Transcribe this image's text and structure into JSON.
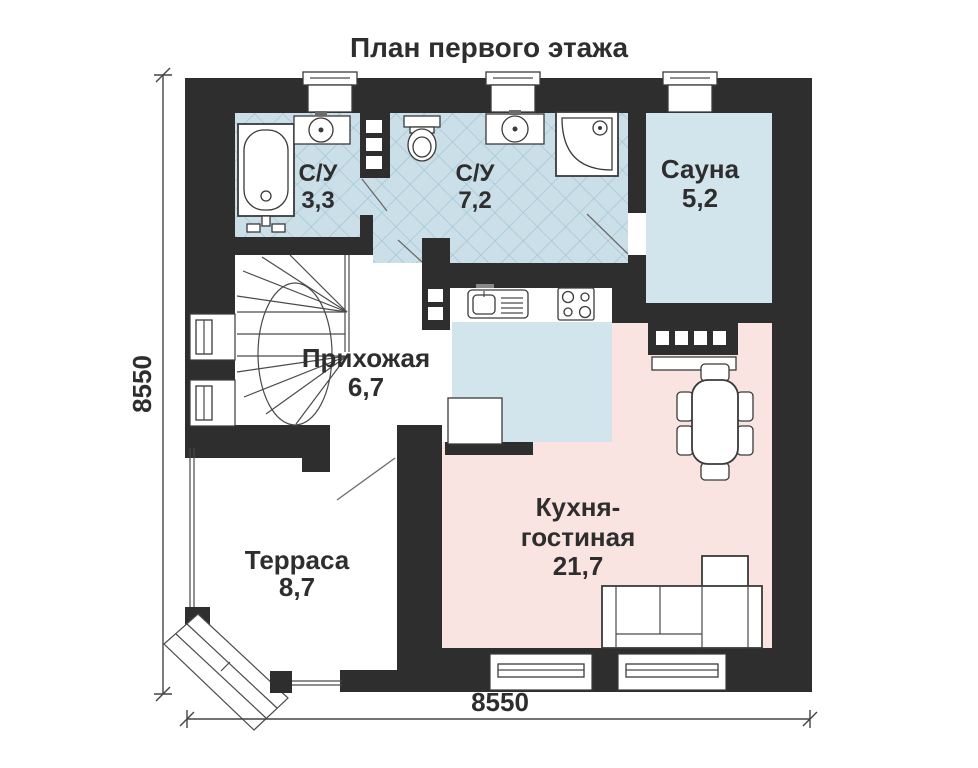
{
  "title": "План первого этажа",
  "dimension_labels": {
    "left": "8550",
    "bottom": "8550"
  },
  "rooms": [
    {
      "id": "bathroom-1",
      "name": "С/У",
      "area": "3,3"
    },
    {
      "id": "bathroom-2",
      "name": "С/У",
      "area": "7,2"
    },
    {
      "id": "sauna",
      "name": "Сауна",
      "area": "5,2"
    },
    {
      "id": "hallway",
      "name": "Прихожая",
      "area": "6,7"
    },
    {
      "id": "kitchen-living",
      "name_line1": "Кухня-",
      "name_line2": "гостиная",
      "area": "21,7"
    },
    {
      "id": "terrace",
      "name": "Терраса",
      "area": "8,7"
    }
  ],
  "fixtures": [
    "bathtub",
    "washbasin",
    "toilet",
    "corner-shower",
    "kitchen-sink",
    "cooktop",
    "sauna-stove",
    "dining-table",
    "chairs",
    "corner-sofa",
    "winder-staircase",
    "entrance-steps",
    "window",
    "vent-window"
  ],
  "colors": {
    "walls": "#2e2e2e",
    "tiled_floor": "#cbdfe9",
    "tile_line": "#9fc2d1",
    "sauna_floor": "#d3e5ec",
    "kitchen_floor": "#d3e5ec",
    "living_floor": "#fae4e1",
    "text": "#2e2e2e",
    "background": "#ffffff"
  }
}
